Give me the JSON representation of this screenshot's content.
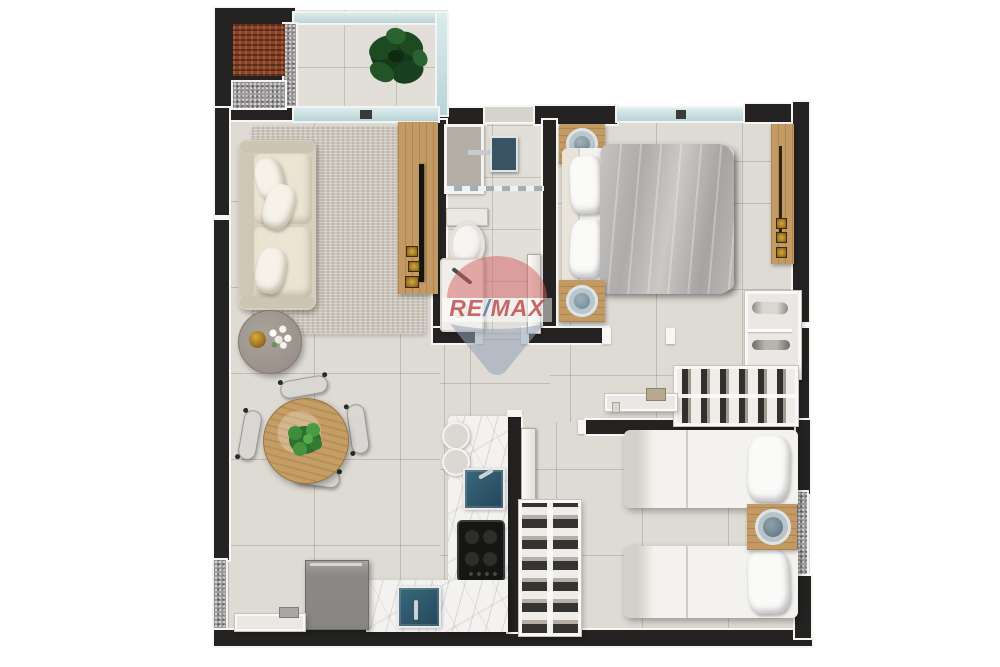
{
  "watermark": {
    "brand": "RE/MAX",
    "brand_re": "RE",
    "brand_slash": "/",
    "brand_max": "MAX",
    "balloon_red": "#cc4f4f",
    "balloon_blue": "#8ea3bd",
    "balloon_white": "#ffffff"
  },
  "palette": {
    "background": "#ffffff",
    "wall": "#242322",
    "wall_trim": "#f7f6f4",
    "floor_tile": "#dedad4",
    "glass_window": "#bdd6d8",
    "granite_speckle": "#9b9997",
    "rug": "#cbc5bb",
    "sofa": "#e4ddcf",
    "wood": "#c39a64",
    "marble": "#f3f2f0",
    "sink_teal": "#2e5766",
    "cooktop_black": "#161616",
    "cabinet_gray": "#908e8b",
    "plant_dark": "#1e4f23",
    "plant_bright": "#3f8f3a",
    "bedding_white": "#f4f2ee",
    "duvet_gray": "#b5b2b0",
    "accent_gold": "#b78a2e",
    "bowl_blue": "#8da0ab",
    "rust_mat": "#8a4527"
  },
  "plan": {
    "type": "apartment-floor-plan",
    "rooms": [
      {
        "id": "balcony",
        "furniture": [
          "ornamental-plant",
          "grill-mat",
          "granite-mat",
          "glass-railing"
        ]
      },
      {
        "id": "living-dining",
        "furniture": [
          "sofa",
          "area-rug",
          "tv-console",
          "tv",
          "coffee-table",
          "round-dining-table",
          "dining-chairs-x4",
          "centerpiece-plant"
        ]
      },
      {
        "id": "bathroom",
        "furniture": [
          "shower",
          "glass-partition",
          "toilet",
          "washbasin",
          "door"
        ]
      },
      {
        "id": "bedroom-1",
        "furniture": [
          "double-bed",
          "nightstand-x2",
          "wardrobe-panel",
          "shelf-unit",
          "clothes-rack",
          "wall-shelf"
        ]
      },
      {
        "id": "bedroom-2",
        "furniture": [
          "single-bed-x2",
          "nightstand",
          "side-window",
          "door"
        ]
      },
      {
        "id": "kitchen-laundry",
        "furniture": [
          "l-shaped-counter",
          "kitchen-sink",
          "cooktop",
          "laundry-sink",
          "appliance-cabinet",
          "wall-shelf",
          "shoe-rack",
          "stools-x2"
        ]
      }
    ]
  }
}
